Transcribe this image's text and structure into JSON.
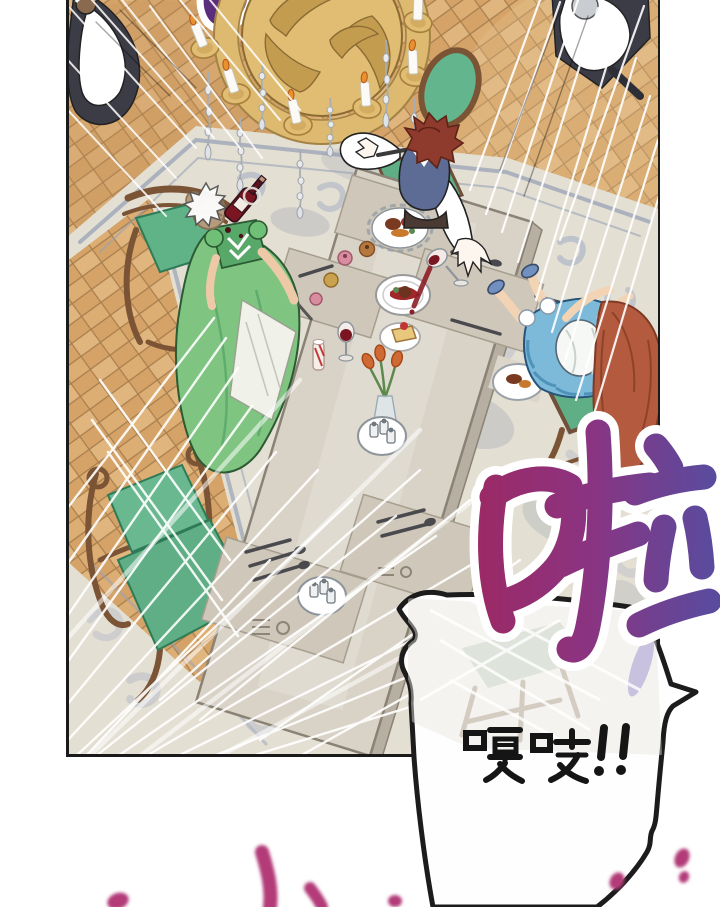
{
  "page": {
    "width": 720,
    "height": 907,
    "background": "#ffffff"
  },
  "panel": {
    "border_color": "#1a1a1a"
  },
  "sfx": {
    "large_char": "啦",
    "creak_text": "嘎吱!!",
    "colors": {
      "large_left": "#9b2a66",
      "large_mid": "#8c3380",
      "large_right": "#5a4b9e",
      "outline": "#ffffff",
      "creak": "#151515",
      "splash": "#b23a78",
      "partial_glyph": "#5a2d7d"
    }
  },
  "scene": {
    "colors": {
      "floor": "#d5a368",
      "floor_light": "#e0b57e",
      "floor_line": "#9a7243",
      "carpet": "#e4dfd3",
      "carpet_border": "#98a2b6",
      "carpet_motif": "#b4bac8",
      "carpet_shadow": "#98a0ae",
      "table": "#d9d3c7",
      "table_edge": "#b7b0a2",
      "placemat": "#cfc8ba",
      "chair_green": "#5fae85",
      "chair_wood": "#7b5435",
      "gold": "#e0bd72",
      "gold_dark": "#c49c50",
      "maid_dress": "#3c3c46",
      "apron": "#ffffff",
      "man_vest": "#5d6c94",
      "man_hair": "#8e3a2c",
      "woman_dress": "#7fc480",
      "woman_hair": "#b49b7d",
      "child_dress": "#7db9d8",
      "child_hair": "#b35a3f",
      "wine": "#7a1622",
      "tulip": "#d06a35",
      "speed_line": "#ffffff",
      "bubble_fill": "#fefefe",
      "bubble_line": "#1c1c1c"
    }
  }
}
